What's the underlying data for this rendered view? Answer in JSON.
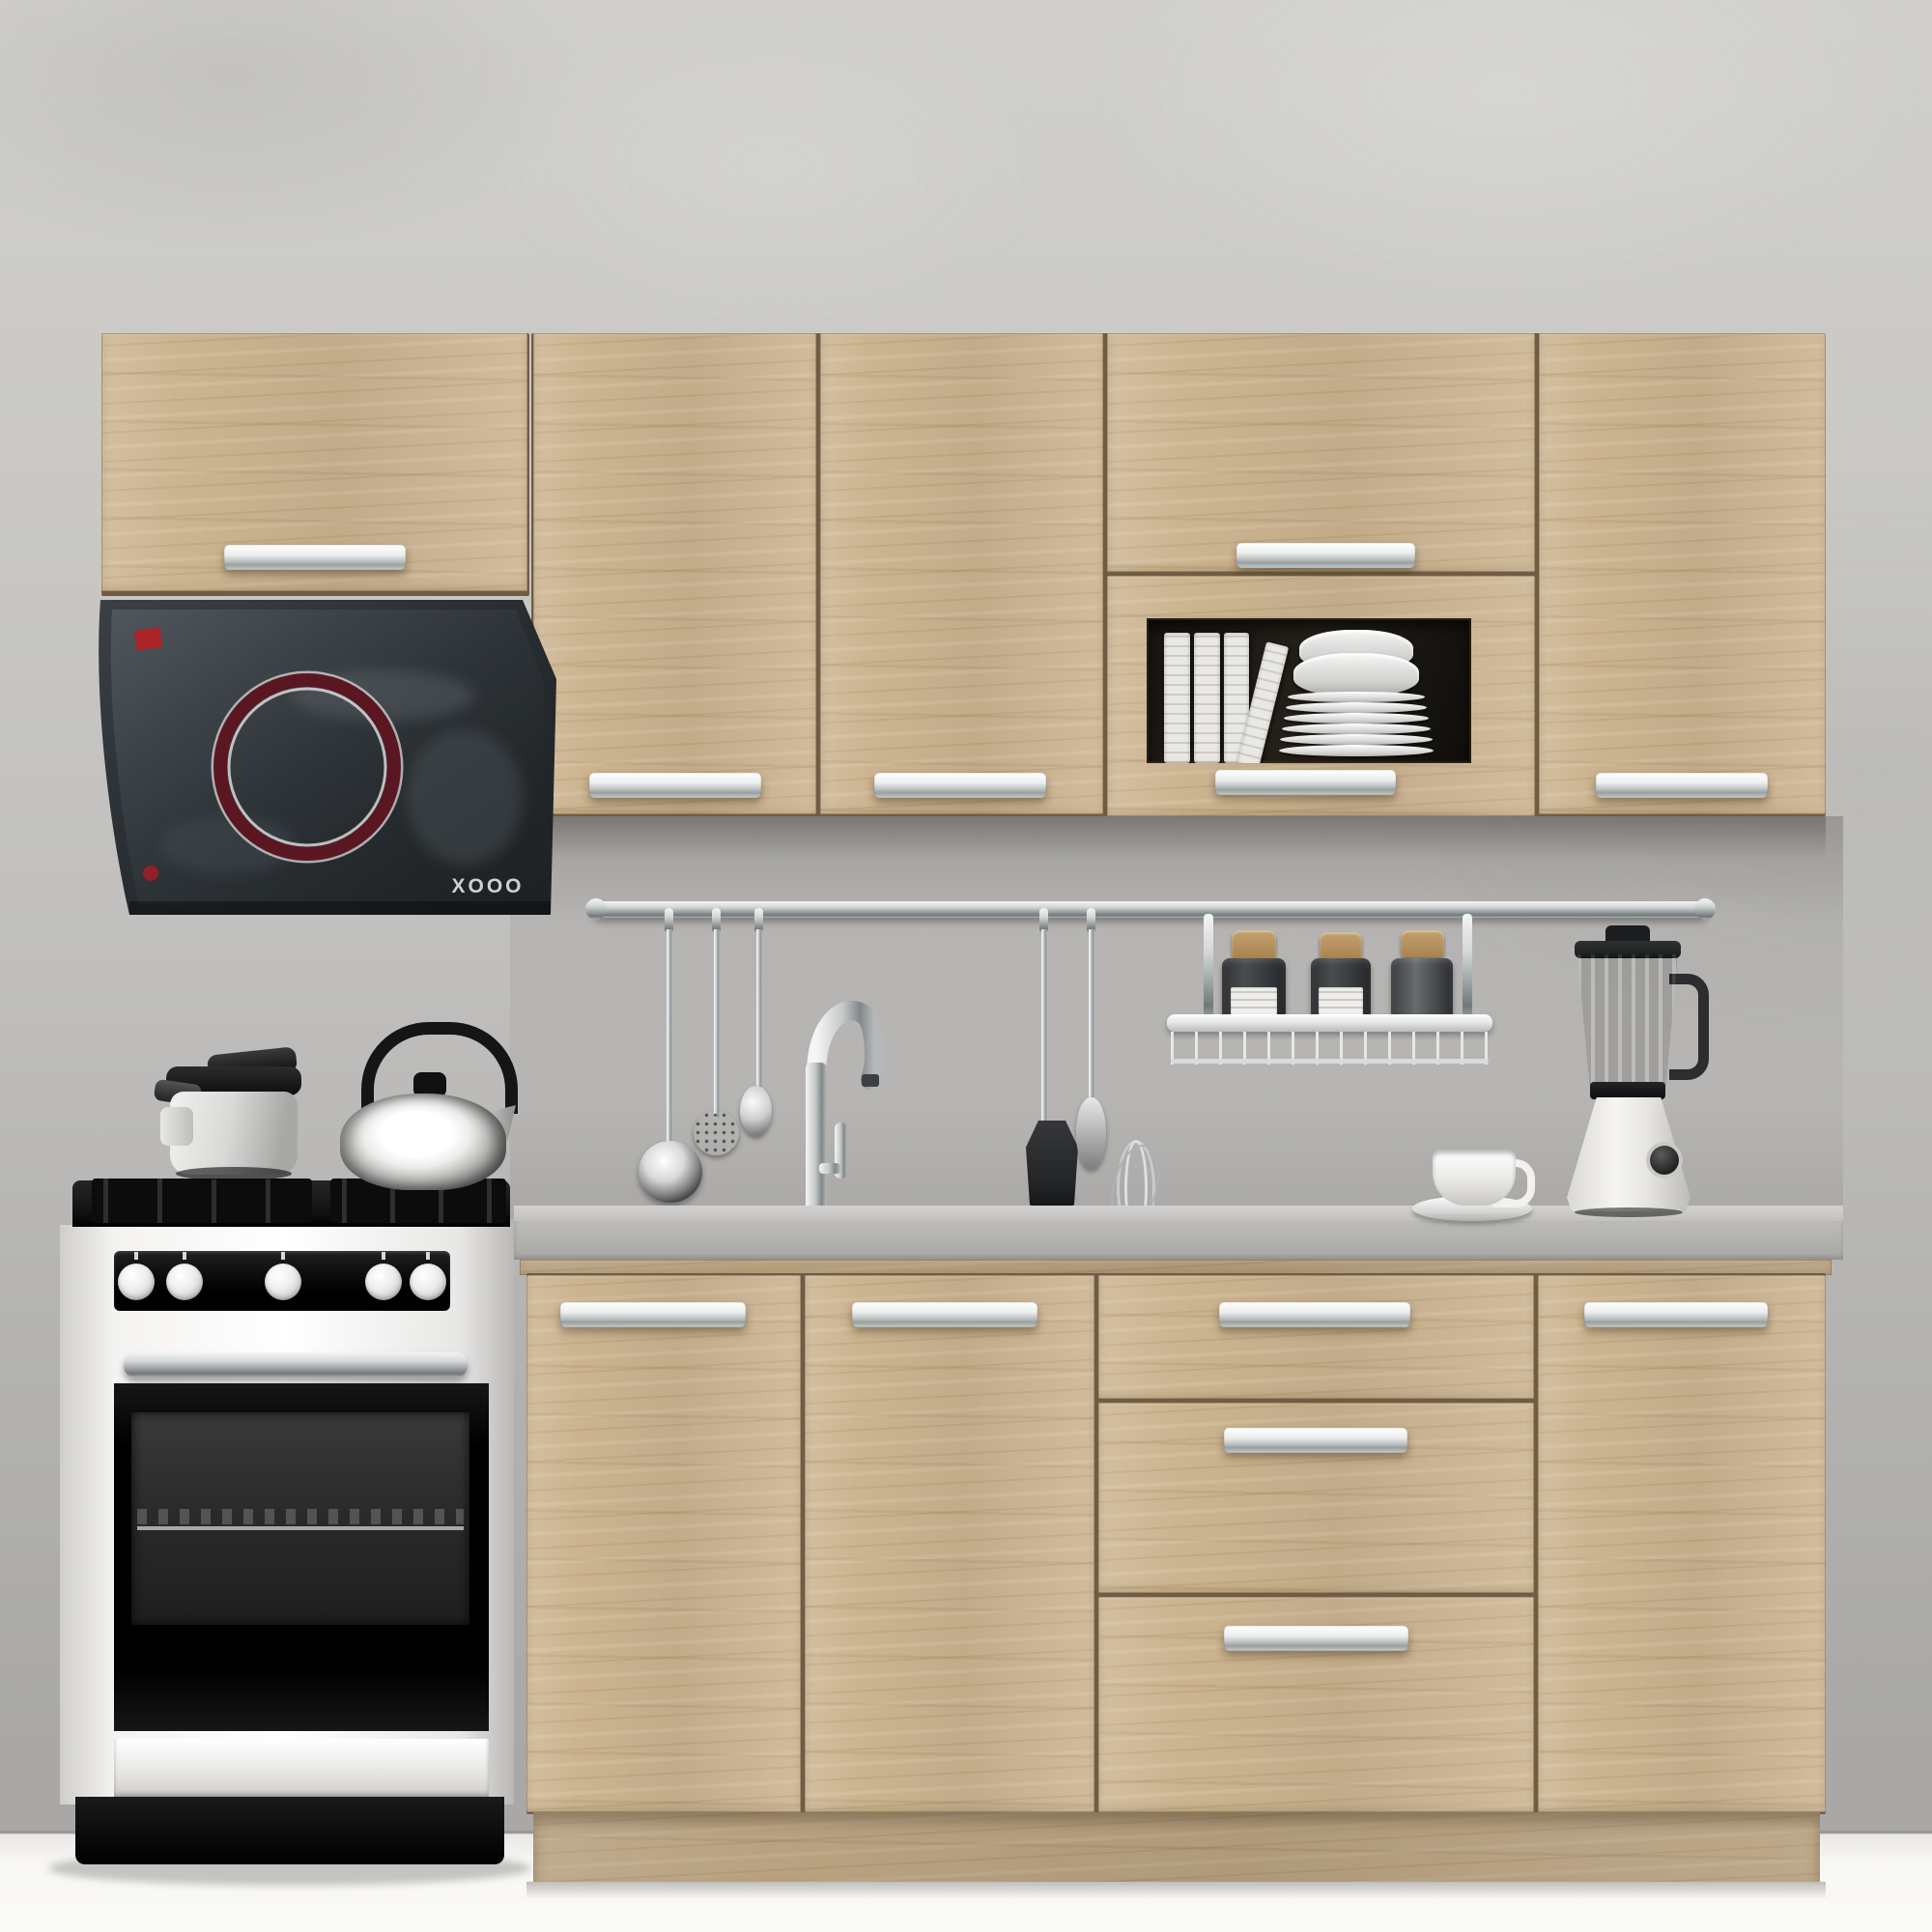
{
  "scene": {
    "kind": "3D product render of a straight modular kitchen set",
    "hood": {
      "brand_text": "XOOO",
      "body_color": "#2b3135",
      "ring_color": "#5a1722",
      "badge_color": "#b61f24"
    },
    "cabinets": {
      "finish": "light sonoma oak",
      "wood_color": "#ccb490",
      "handle_color": "#d9dcdc",
      "upper_units": [
        "wall-door-over-hood",
        "wall-door-2",
        "wall-door-3",
        "wall-flap-door",
        "glass-display-door",
        "wall-door-5"
      ],
      "base_units": [
        "base-door-1",
        "base-door-2",
        "drawer-unit-3-drawers",
        "base-door-3"
      ],
      "drawer_count": 3
    },
    "countertop": {
      "color": "#b7b6b4"
    },
    "appliances": [
      "chimney-range-hood",
      "freestanding-gas-range-with-oven",
      "blender"
    ],
    "range": {
      "knob_count": 5,
      "body_color": "#f2f1ef",
      "panel_color": "#111111"
    },
    "props": [
      "pressure-cooker",
      "stovetop-kettle",
      "wall-rail",
      "hanging-ladle",
      "hanging-skimmer",
      "hanging-spoon",
      "hanging-turner",
      "hanging-server",
      "hanging-whisk",
      "spice-shelf-basket",
      "spice-jars",
      "glass-cabinet-books",
      "glass-cabinet-plates",
      "coffee-cup-and-saucer",
      "sink",
      "faucet"
    ],
    "spice_jar_count": 3,
    "wall_color": "#c8c7c5",
    "floor_color": "#f8f7f5"
  }
}
